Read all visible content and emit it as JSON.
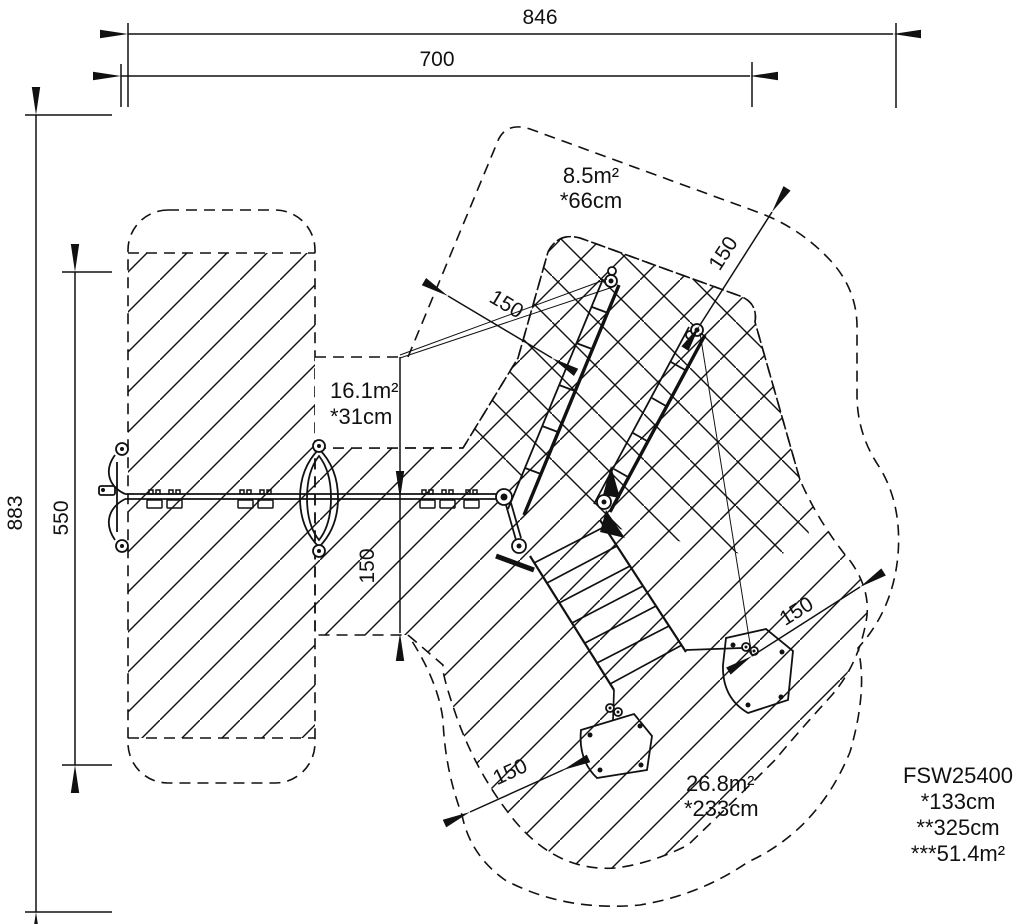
{
  "drawing": {
    "type": "playground-equipment-plan-view",
    "units": "cm",
    "line_color": "#111111",
    "background": "#ffffff"
  },
  "dimensions": {
    "width_total": "846",
    "width_inner": "700",
    "height_total": "883",
    "height_inner": "550"
  },
  "clearance": {
    "value": "150"
  },
  "zones": {
    "upper": {
      "area": "8.5m²",
      "fall_height": "*66cm"
    },
    "middle": {
      "area": "16.1m²",
      "fall_height": "*31cm"
    },
    "lower": {
      "area": "26.8m²",
      "fall_height": "*233cm"
    }
  },
  "product": {
    "model": "FSW25400",
    "fall_height": "*133cm",
    "total_height": "**325cm",
    "total_area": "***51.4m²"
  }
}
